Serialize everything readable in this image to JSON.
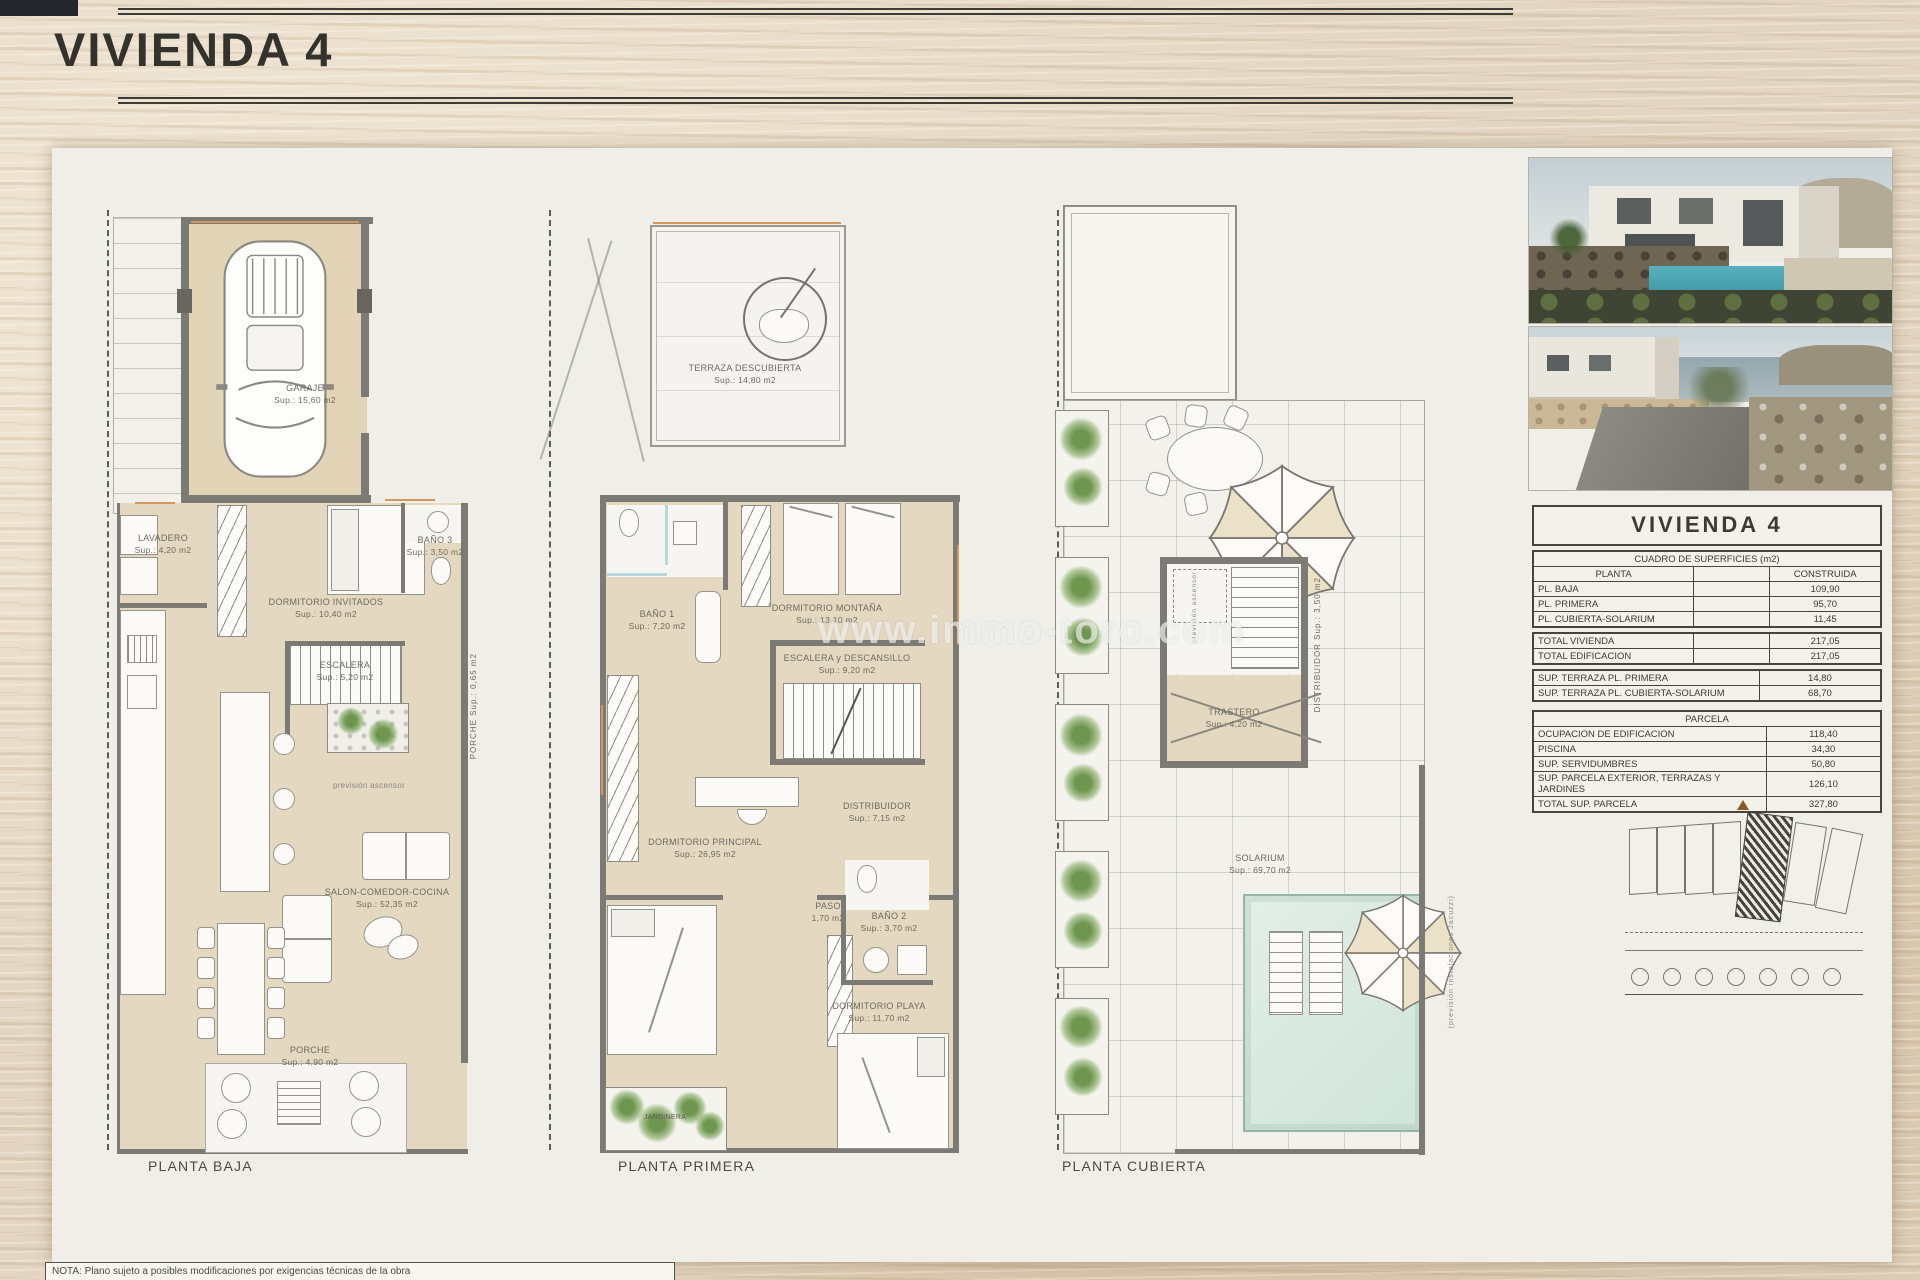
{
  "title": "VIVIENDA 4",
  "watermark": "www.immo-toro.com",
  "plans": {
    "baja": {
      "caption": "PLANTA BAJA"
    },
    "primera": {
      "caption": "PLANTA PRIMERA"
    },
    "cubierta": {
      "caption": "PLANTA CUBIERTA"
    }
  },
  "rooms": {
    "garaje": {
      "name": "GARAJE",
      "area": "Sup.: 15,60  m2"
    },
    "lavadero": {
      "name": "LAVADERO",
      "area": "Sup.: 4,20  m2"
    },
    "dorm_invitados": {
      "name": "DORMITORIO INVITADOS",
      "area": "Sup.: 10,40  m2"
    },
    "bano3": {
      "name": "BAÑO 3",
      "area": "Sup.: 3,50  m2"
    },
    "escalera_pb": {
      "name": "ESCALERA",
      "area": "Sup.: 5,20  m2"
    },
    "porche_lateral": {
      "name": "PORCHE",
      "area": "Sup.: 0,65  m2"
    },
    "ascensor": "previsión ascensor",
    "salon": {
      "name": "SALON-COMEDOR-COCINA",
      "area": "Sup.: 52,35  m2"
    },
    "porche": {
      "name": "PORCHE",
      "area": "Sup.: 4,90  m2"
    },
    "terraza": {
      "name": "TERRAZA DESCUBIERTA",
      "area": "Sup.: 14,80  m2"
    },
    "bano1": {
      "name": "BAÑO 1",
      "area": "Sup.: 7,20  m2"
    },
    "dorm_montana": {
      "name": "DORMITORIO MONTAÑA",
      "area": "Sup.: 13,10  m2"
    },
    "escalera_p1": {
      "name": "ESCALERA y DESCANSILLO",
      "area": "Sup.: 9,20  m2"
    },
    "dorm_principal": {
      "name": "DORMITORIO PRINCIPAL",
      "area": "Sup.: 26,95  m2"
    },
    "distribuidor_p1": {
      "name": "DISTRIBUIDOR",
      "area": "Sup.: 7,15  m2"
    },
    "paso": {
      "name": "PASO",
      "area": "1,70 m2"
    },
    "bano2": {
      "name": "BAÑO 2",
      "area": "Sup.: 3,70  m2"
    },
    "dorm_playa": {
      "name": "DORMITORIO PLAYA",
      "area": "Sup.: 11,70  m2"
    },
    "jardinera": "JARDINERA",
    "distribuidor_pc": {
      "name": "DISTRIBUIDOR",
      "area": "Sup.: 3,50 m2"
    },
    "trastero": {
      "name": "TRASTERO",
      "area": "Sup.: 4,20  m2"
    },
    "solarium": {
      "name": "SOLARIUM",
      "area": "Sup.: 69,70  m2"
    },
    "jacuzzi": "(previsión instalaciones Jacuzzi)"
  },
  "table": {
    "title": "VIVIENDA 4",
    "subtitle": "CUADRO DE SUPERFICIES (m2)",
    "col_planta": "PLANTA",
    "col_construida": "CONSTRUIDA",
    "rows_plantas": [
      {
        "label": "PL. BAJA",
        "value": "109,90"
      },
      {
        "label": "PL. PRIMERA",
        "value": "95,70"
      },
      {
        "label": "PL. CUBIERTA-SOLARIUM",
        "value": "11,45"
      }
    ],
    "rows_totales": [
      {
        "label": "TOTAL VIVIENDA",
        "value": "217,05"
      },
      {
        "label": "TOTAL EDIFICACION",
        "value": "217,05"
      }
    ],
    "rows_terrazas": [
      {
        "label": "SUP. TERRAZA PL. PRIMERA",
        "value": "14,80"
      },
      {
        "label": "SUP. TERRAZA PL. CUBIERTA-SOLARIUM",
        "value": "68,70"
      }
    ],
    "parcela_title": "PARCELA",
    "rows_parcela": [
      {
        "label": "OCUPACION DE EDIFICACION",
        "value": "118,40"
      },
      {
        "label": "PISCINA",
        "value": "34,30"
      },
      {
        "label": "SUP. SERVIDUMBRES",
        "value": "50,80"
      },
      {
        "label": "SUP. PARCELA EXTERIOR, TERRAZAS Y JARDINES",
        "value": "126,10"
      },
      {
        "label": "TOTAL SUP. PARCELA",
        "value": "327,80"
      }
    ]
  },
  "note": "NOTA: Plano sujeto a posibles modificaciones por exigencias técnicas de la obra",
  "colors": {
    "floor_beige": "#e4d8c0",
    "wall_gray": "#7b7a74",
    "accent_wood": "#d6975a",
    "pool": "#dcebe2",
    "plant_green": "#608c3e",
    "sheet": "#efeee8"
  }
}
